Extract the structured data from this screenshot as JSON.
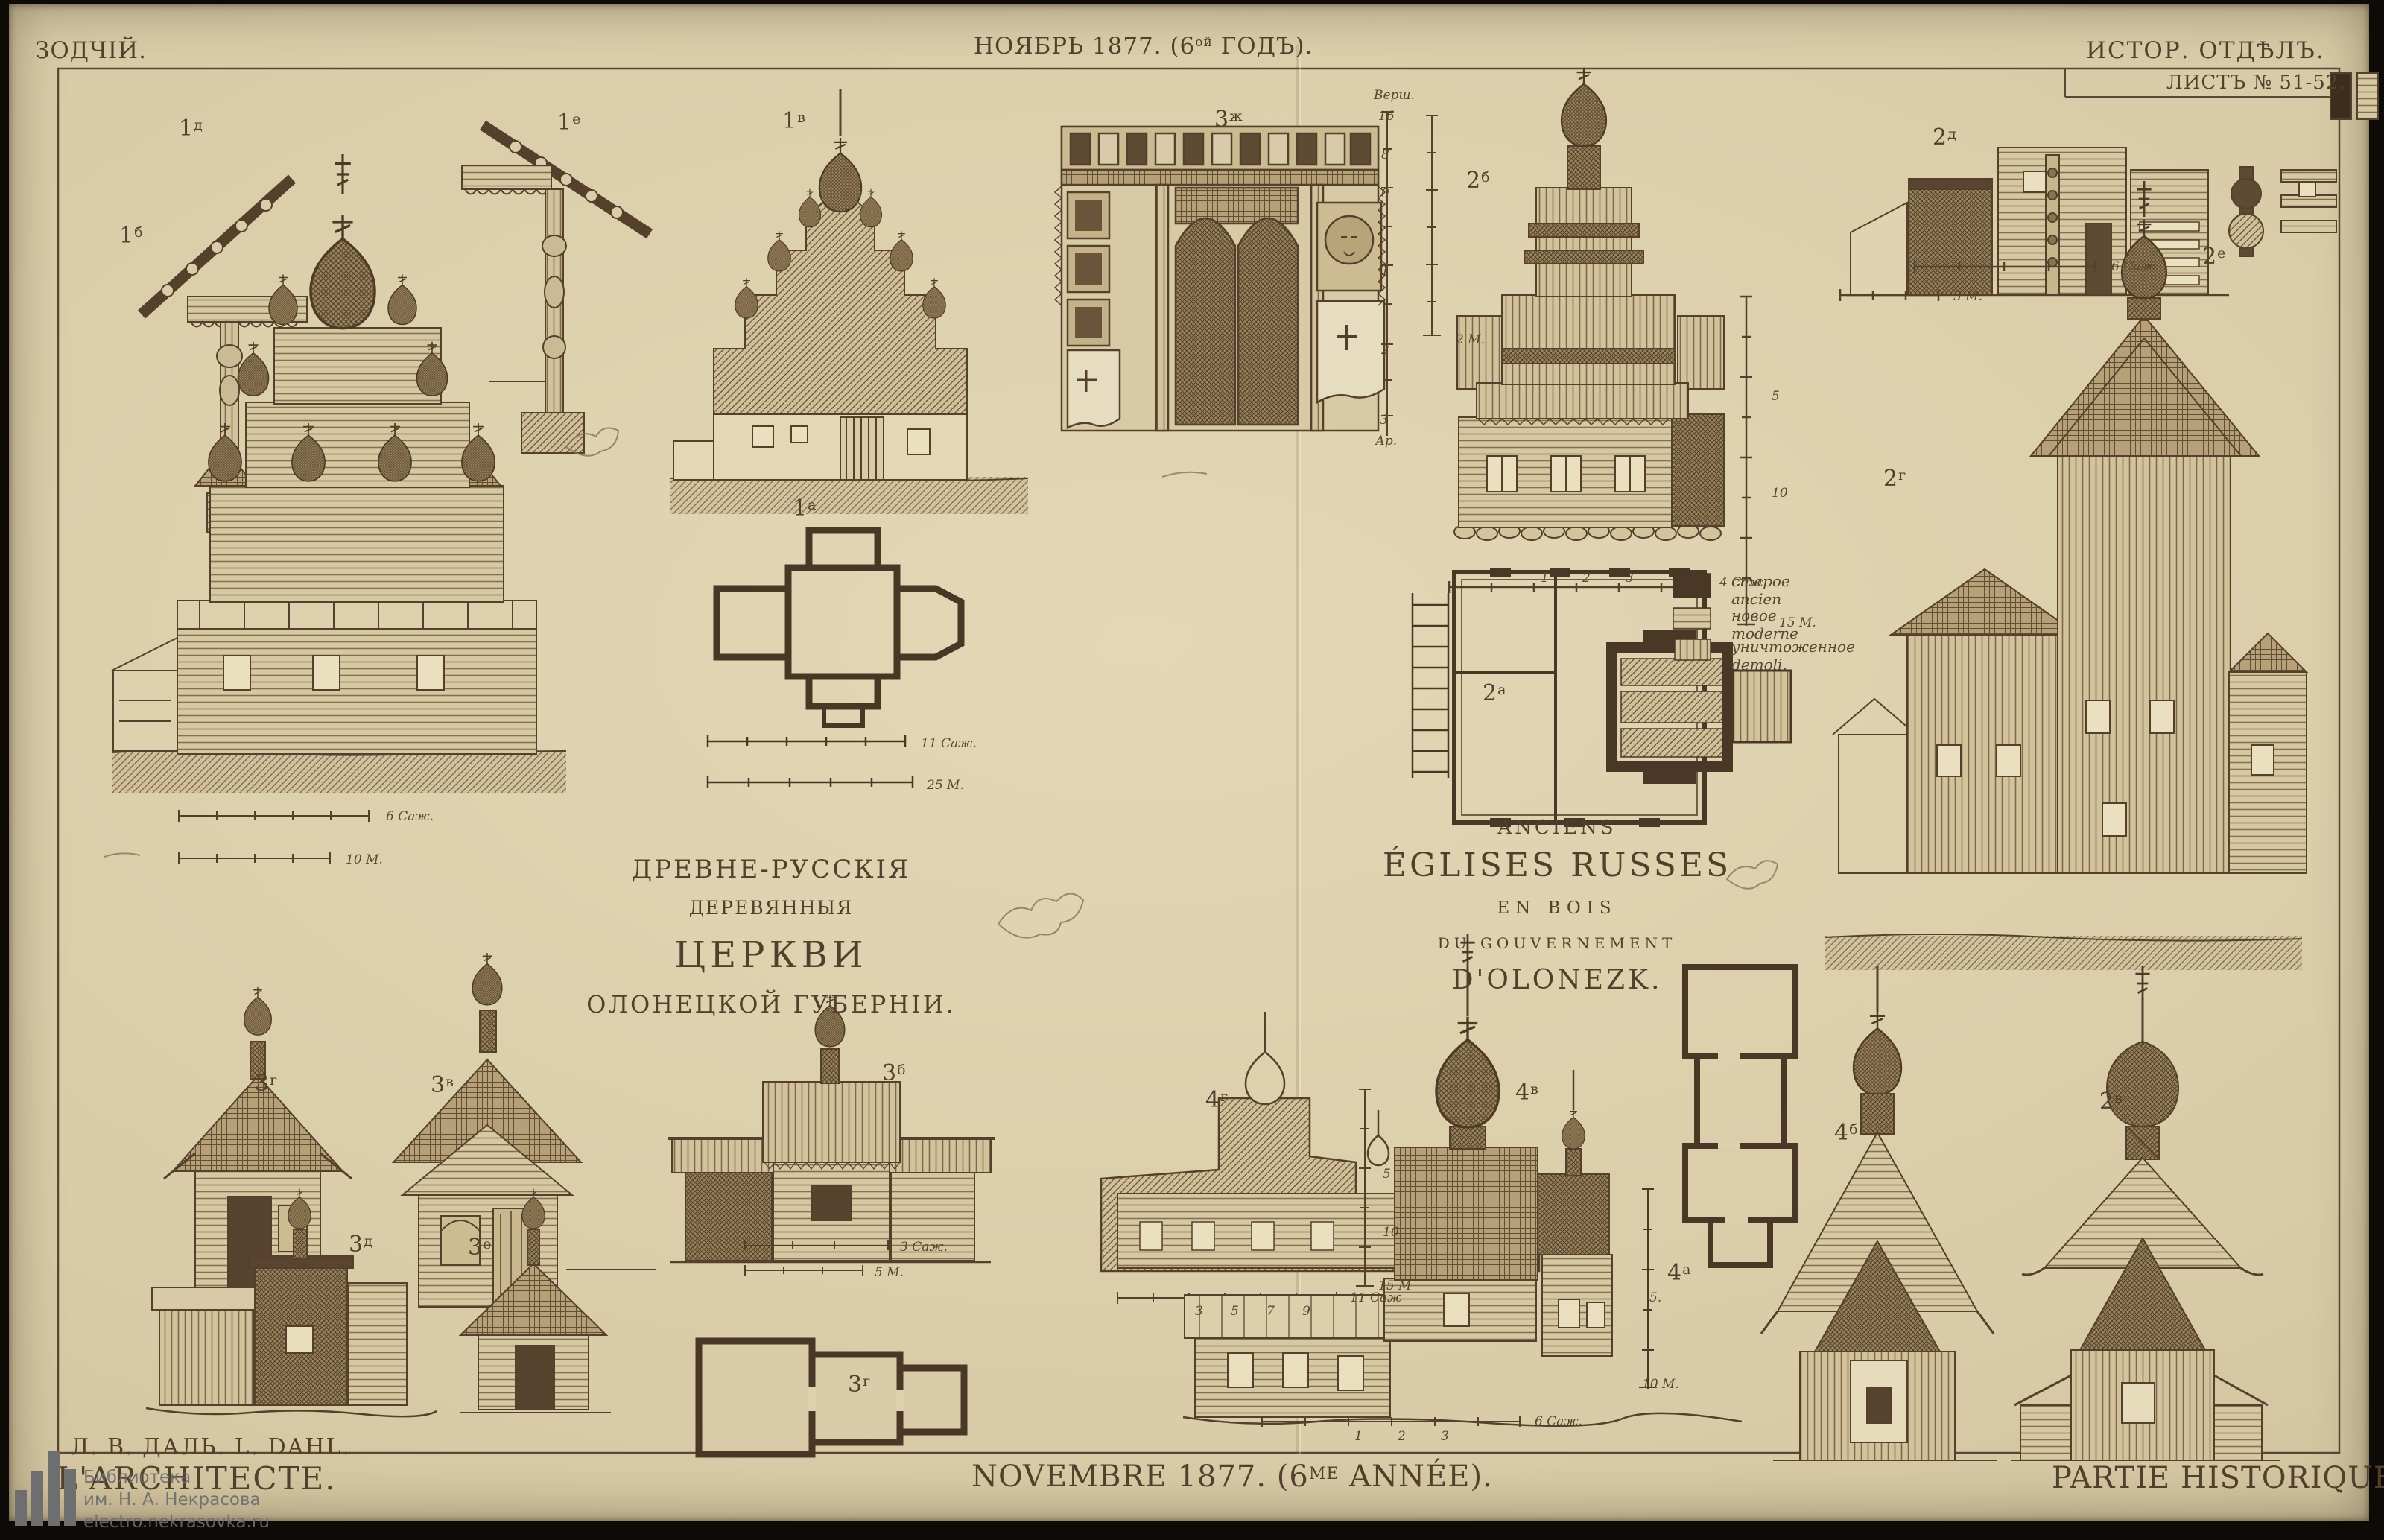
{
  "header": {
    "masthead": "ЗОДЧІЙ.",
    "issue_pre": "НОЯБРЬ 1877. (6",
    "issue_sup": "ой",
    "issue_post": " ГОДЪ).",
    "section": "ИСТОР. ОТДѢЛЪ.",
    "sheet": "ЛИСТЪ № 51-52."
  },
  "footer": {
    "authors": "Л. В. ДАЛЬ.  L. DAHL.",
    "journal_fr": "L'ARCHITECTE.",
    "issue_pre": "NOVEMBRE 1877. (6",
    "issue_sup": "ME",
    "issue_post": " ANNÉE).",
    "section_fr": "PARTIE HISTORIQUE."
  },
  "watermark": {
    "line1": "Библиотека",
    "line2": "им. Н. А. Некрасова",
    "line3": "electro.nekrasovka.ru"
  },
  "titles": {
    "ru": [
      "ДРЕВНЕ-РУССКІЯ",
      "ДЕРЕВЯННЫЯ",
      "ЦЕРКВИ",
      "ОЛОНЕЦКОЙ ГУБЕРНІИ."
    ],
    "fr": [
      "ANCIENS",
      "ÉGLISES RUSSES",
      "EN BOIS",
      "DU GOUVERNEMENT",
      "D'OLONEZK."
    ]
  },
  "legend": {
    "items": [
      {
        "ru": "старое",
        "fr": "ancien"
      },
      {
        "ru": "новое",
        "fr": "moderne"
      },
      {
        "ru": "уничтоженное",
        "fr": "demoli."
      }
    ]
  },
  "figure_labels": [
    {
      "num": "1",
      "sup": "д"
    },
    {
      "num": "1",
      "sup": "е"
    },
    {
      "num": "1",
      "sup": "б"
    },
    {
      "num": "1",
      "sup": "в"
    },
    {
      "num": "1",
      "sup": "а"
    },
    {
      "num": "3",
      "sup": "ж"
    },
    {
      "num": "2",
      "sup": "б"
    },
    {
      "num": "2",
      "sup": "д"
    },
    {
      "num": "2",
      "sup": "е"
    },
    {
      "num": "2",
      "sup": "г"
    },
    {
      "num": "2",
      "sup": "а"
    },
    {
      "num": "3",
      "sup": "г"
    },
    {
      "num": "3",
      "sup": "в"
    },
    {
      "num": "3",
      "sup": "б"
    },
    {
      "num": "3",
      "sup": "д"
    },
    {
      "num": "3",
      "sup": "е"
    },
    {
      "num": "3",
      "sup": "г"
    },
    {
      "num": "4",
      "sup": "г"
    },
    {
      "num": "4",
      "sup": "в"
    },
    {
      "num": "4",
      "sup": "а"
    },
    {
      "num": "4",
      "sup": "б"
    },
    {
      "num": "2",
      "sup": "в"
    }
  ],
  "scales": [
    {
      "text": "6 Саж."
    },
    {
      "text": "10 М."
    },
    {
      "text": "11 Саж."
    },
    {
      "text": "25 М."
    },
    {
      "text": "Верш."
    },
    {
      "text": "16"
    },
    {
      "text": "8"
    },
    {
      "text": "0"
    },
    {
      "text": "1"
    },
    {
      "text": "2"
    },
    {
      "text": "3"
    },
    {
      "text": "Ар."
    },
    {
      "text": "2 М."
    },
    {
      "text": "4 Саж."
    },
    {
      "text": "5"
    },
    {
      "text": "10"
    },
    {
      "text": "15 М."
    },
    {
      "text": "6 Саж."
    },
    {
      "text": "5 М."
    },
    {
      "text": "3 Саж."
    },
    {
      "text": "5 М."
    },
    {
      "text": "11 Саж"
    },
    {
      "text": "5"
    },
    {
      "text": "10"
    },
    {
      "text": "15 М"
    },
    {
      "text": "6 Саж."
    },
    {
      "text": "5."
    },
    {
      "text": "10 М."
    },
    {
      "text": "1"
    },
    {
      "text": "2"
    },
    {
      "text": "3"
    },
    {
      "text": "1"
    },
    {
      "text": "2"
    },
    {
      "text": "3"
    },
    {
      "text": "3"
    },
    {
      "text": "5"
    },
    {
      "text": "7"
    },
    {
      "text": "9"
    }
  ]
}
